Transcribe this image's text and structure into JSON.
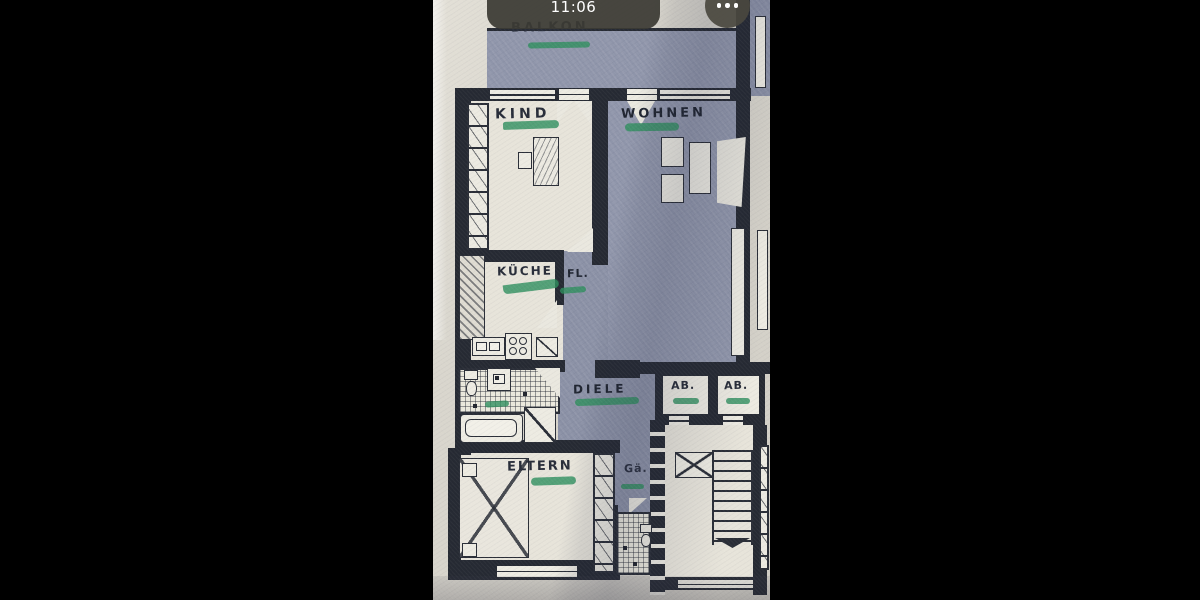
{
  "viewer": {
    "date_label": "Heute",
    "time_label": "11:06",
    "more_icon": "ellipsis-icon"
  },
  "floor_plan": {
    "marker_color": "#2e8f5e",
    "shade_color": "#8f95aa",
    "wall_color": "#262a33",
    "paper_color": "#d9d6cd",
    "rooms": [
      {
        "id": "balkon",
        "label": "BALKON"
      },
      {
        "id": "kind",
        "label": "KIND"
      },
      {
        "id": "wohnen",
        "label": "WOHNEN"
      },
      {
        "id": "kueche",
        "label": "KÜCHE"
      },
      {
        "id": "flur",
        "label": "FL."
      },
      {
        "id": "diele",
        "label": "DIELE"
      },
      {
        "id": "abstellraum-1",
        "label": "AB."
      },
      {
        "id": "abstellraum-2",
        "label": "AB."
      },
      {
        "id": "eltern",
        "label": "ELTERN"
      },
      {
        "id": "gaeste-wc",
        "label": "Gä."
      }
    ]
  }
}
